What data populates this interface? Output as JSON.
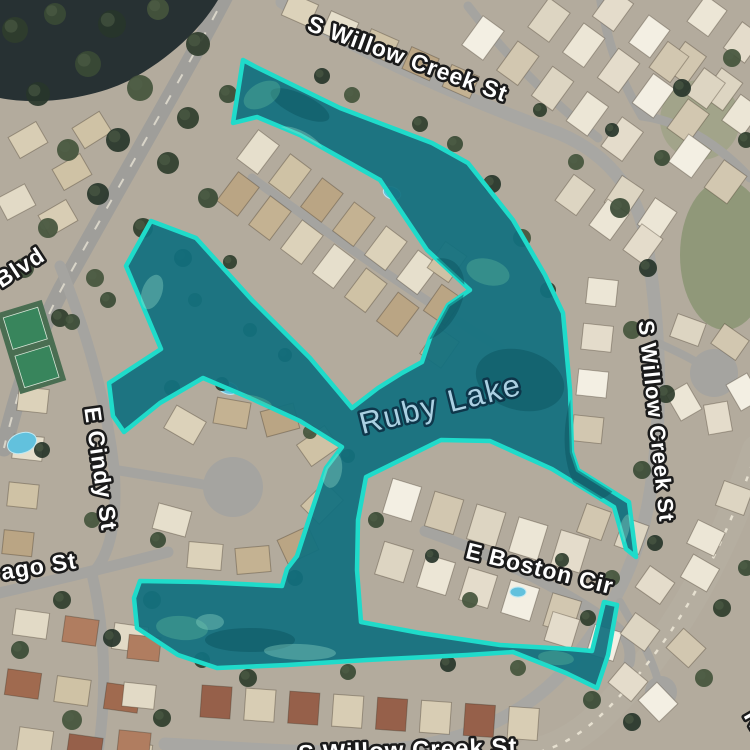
{
  "map": {
    "view_title": "Ruby Lake satellite map",
    "lake": {
      "name": "Ruby Lake",
      "selection_stroke": "#1fdbca",
      "selection_fill": "#11707f",
      "selection_fill_opacity": 0.93,
      "polygon": [
        [
          243,
          60
        ],
        [
          256,
          67
        ],
        [
          340,
          108
        ],
        [
          432,
          143
        ],
        [
          468,
          163
        ],
        [
          513,
          220
        ],
        [
          545,
          275
        ],
        [
          563,
          313
        ],
        [
          570,
          390
        ],
        [
          572,
          452
        ],
        [
          578,
          470
        ],
        [
          629,
          502
        ],
        [
          636,
          557
        ],
        [
          626,
          549
        ],
        [
          614,
          507
        ],
        [
          552,
          469
        ],
        [
          490,
          441
        ],
        [
          441,
          440
        ],
        [
          366,
          477
        ],
        [
          358,
          520
        ],
        [
          357,
          570
        ],
        [
          361,
          622
        ],
        [
          420,
          633
        ],
        [
          500,
          645
        ],
        [
          570,
          649
        ],
        [
          592,
          651
        ],
        [
          604,
          602
        ],
        [
          617,
          605
        ],
        [
          608,
          655
        ],
        [
          597,
          688
        ],
        [
          566,
          673
        ],
        [
          513,
          652
        ],
        [
          467,
          655
        ],
        [
          367,
          660
        ],
        [
          287,
          665
        ],
        [
          217,
          668
        ],
        [
          178,
          655
        ],
        [
          137,
          628
        ],
        [
          134,
          598
        ],
        [
          140,
          581
        ],
        [
          200,
          582
        ],
        [
          282,
          586
        ],
        [
          287,
          569
        ],
        [
          297,
          556
        ],
        [
          312,
          510
        ],
        [
          326,
          468
        ],
        [
          342,
          447
        ],
        [
          300,
          421
        ],
        [
          250,
          398
        ],
        [
          203,
          378
        ],
        [
          160,
          403
        ],
        [
          124,
          432
        ],
        [
          113,
          416
        ],
        [
          109,
          383
        ],
        [
          161,
          349
        ],
        [
          126,
          266
        ],
        [
          151,
          221
        ],
        [
          196,
          238
        ],
        [
          252,
          300
        ],
        [
          310,
          358
        ],
        [
          352,
          408
        ],
        [
          378,
          388
        ],
        [
          402,
          373
        ],
        [
          422,
          362
        ],
        [
          430,
          338
        ],
        [
          448,
          305
        ],
        [
          470,
          290
        ],
        [
          427,
          250
        ],
        [
          380,
          180
        ],
        [
          300,
          135
        ],
        [
          257,
          117
        ],
        [
          233,
          123
        ]
      ]
    },
    "labels": {
      "lake_label": {
        "text": "Ruby Lake",
        "x": 443,
        "y": 414,
        "rot": -14,
        "size": 31,
        "color": "#abd0e2"
      },
      "street_labels": [
        {
          "text": "S Willow Creek St",
          "x": 405,
          "y": 66,
          "rot": 20,
          "size": 23
        },
        {
          "text": "Blvd",
          "x": 24,
          "y": 274,
          "rot": -33,
          "size": 23
        },
        {
          "text": "E Cindy St",
          "x": 93,
          "y": 470,
          "rot": 82,
          "size": 23
        },
        {
          "text": "ago St",
          "x": 40,
          "y": 574,
          "rot": -9,
          "size": 23
        },
        {
          "text": "E Boston Cir",
          "x": 538,
          "y": 576,
          "rot": 14,
          "size": 23
        },
        {
          "text": "S Willow Creek St",
          "x": 649,
          "y": 422,
          "rot": 84,
          "size": 22
        },
        {
          "text": "S Willow Creek St",
          "x": 408,
          "y": 758,
          "rot": -2,
          "size": 24
        },
        {
          "text": "N",
          "x": 748,
          "y": 724,
          "rot": 60,
          "size": 26
        }
      ]
    }
  }
}
